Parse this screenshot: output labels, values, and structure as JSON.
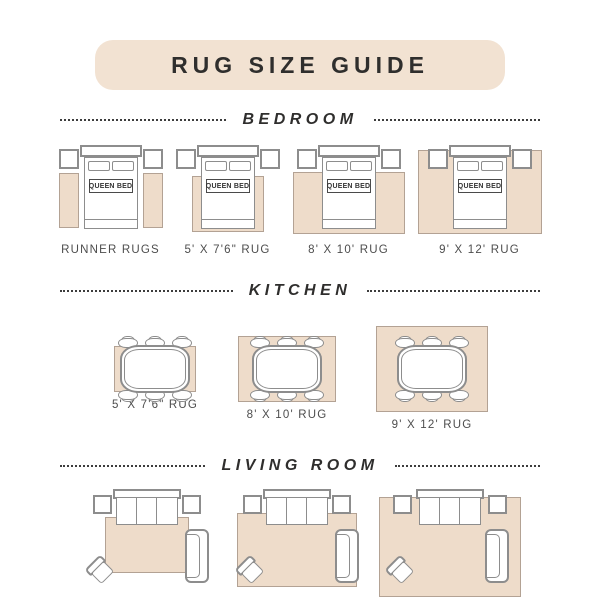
{
  "page": {
    "title": "RUG SIZE GUIDE"
  },
  "bed_label": "QUEEN BED",
  "colors": {
    "banner_bg": "#f2e2d2",
    "rug_fill": "#eedcca",
    "rug_border": "#b3a294",
    "line": "#8d8d8d",
    "text_dark": "#2f2e2d",
    "label_text": "#4d4d4d"
  },
  "sections": [
    {
      "name": "BEDROOM",
      "items": [
        {
          "label": "RUNNER RUGS"
        },
        {
          "label": "5' X 7'6\" RUG"
        },
        {
          "label": "8' X 10' RUG"
        },
        {
          "label": "9' X 12' RUG"
        }
      ]
    },
    {
      "name": "KITCHEN",
      "items": [
        {
          "label": "5' X 7'6\" RUG"
        },
        {
          "label": "8' X 10' RUG"
        },
        {
          "label": "9' X 12' RUG"
        }
      ]
    },
    {
      "name": "LIVING ROOM",
      "items": [
        {
          "label": "5' X 7'6\" RUG"
        },
        {
          "label": "8' X 10' RUG"
        },
        {
          "label": "9' X 12' RUG"
        }
      ]
    }
  ]
}
